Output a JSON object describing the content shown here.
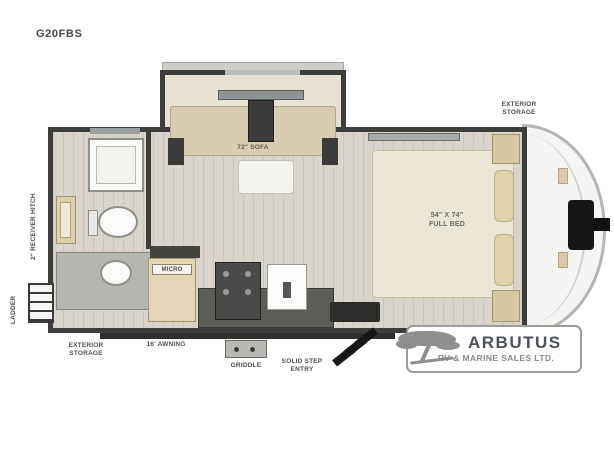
{
  "title": {
    "model": "G20FBS"
  },
  "plan": {
    "labels": {
      "exterior_storage_top": "EXTERIOR\nSTORAGE",
      "receiver_hitch": "2\" RECEIVER HITCH",
      "ladder": "LADDER",
      "exterior_storage_bottom": "EXTERIOR\nSTORAGE",
      "awning": "16' AWNING",
      "griddle": "GRIDDLE",
      "solid_step_entry": "SOLID STEP\nENTRY",
      "micro": "MICRO",
      "sofa": "72\" SOFA",
      "bed": "54\" X 74\"\nFULL BED"
    }
  },
  "logo": {
    "name": "ARBUTUS",
    "tagline": "RV & MARINE SALES LTD."
  },
  "colors": {
    "wall": "#3d3d3c",
    "floor": "#d9d5cc",
    "cabinet_wood": "#dccfae",
    "sofa_tan": "#d8cdb2",
    "bed_cream": "#ece6d6",
    "counter_dark": "#5c5c58",
    "hitch_black": "#161616",
    "logo_gray": "#8f8f8f",
    "logo_text": "#4d525a",
    "background": "#ffffff"
  }
}
